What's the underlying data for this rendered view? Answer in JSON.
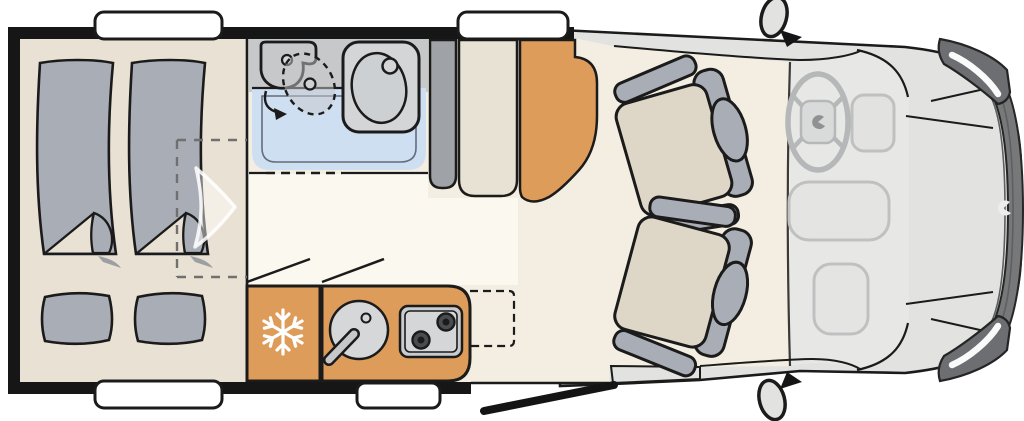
{
  "floorplan": {
    "type": "campervan-floor-plan-top-view",
    "orientation": "rear-left-front-right",
    "zones": {
      "rear_bedroom": {
        "single_beds": 2,
        "pillows": 2,
        "option_outline": "dashed-rectangle"
      },
      "bathroom": {
        "fixtures": [
          "swivel-toilet",
          "washbasin",
          "shower-floor"
        ],
        "door": "dashed-sliding-door"
      },
      "cabinets": [
        "gray-partition",
        "beige-wardrobe",
        "orange-wardrobe"
      ],
      "kitchen": {
        "appliances": [
          "refrigerator",
          "round-sink",
          "two-burner-hob"
        ],
        "burners": 2,
        "worktop_extension": "dashed-outline"
      },
      "lounge": {
        "swivel_seats": 2
      },
      "cab": {
        "features": [
          "steering-wheel",
          "dashboard",
          "engine-hood-panels",
          "grille",
          "headlights",
          "brand-logo"
        ]
      },
      "openings": {
        "windows": 4,
        "entry_door": 1,
        "entry_step": 1,
        "side_mirrors": 2
      }
    },
    "icons": {
      "fridge": "snowflake"
    }
  },
  "palette": {
    "outline": "#1b1b1b",
    "floor_living": "#f3eee1",
    "floor_bedroom": "#e9e2d4",
    "floor_corridor": "#fbf8f0",
    "mattress": "#a9adb5",
    "bath_wall": "#c7c8c9",
    "bath_floor": "#cfdff2",
    "basin": "#d3d5d7",
    "wardrobe_gray": "#9fa2a6",
    "wardrobe_beige": "#e8e2d5",
    "orange": "#dd9c5a",
    "seat_cushion": "#ded7c8",
    "seat_frame": "#a9adb5",
    "cab_body": "#e2e3e1",
    "cab_interior": "#e7e8e6",
    "grille": "#76787a",
    "headlight": "#6c6e71",
    "stove": "#c9ccce",
    "sink": "#d5d7d9",
    "window": "#ffffff",
    "snowflake": "#ffffff"
  }
}
